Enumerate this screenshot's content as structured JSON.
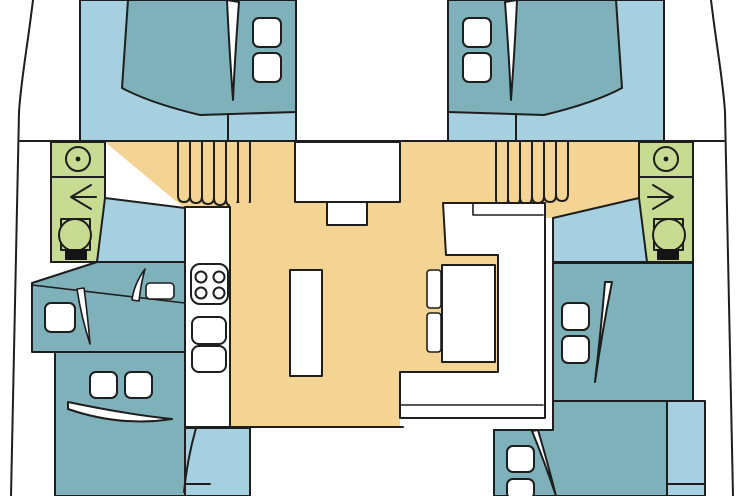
{
  "title": "Catamaran interior layout plan (top view)",
  "colors": {
    "background": "#FFFFFF",
    "floor": "#A6D0DF",
    "bed": "#7FB1BA",
    "salon": "#F3D494",
    "head": "#C7DB93",
    "white": "#FFFFFF",
    "outline": "#1E1E1E",
    "toilet_seat": "#141414"
  },
  "icons": [
    "shower-drain-icon",
    "arrow-left-icon",
    "arrow-right-icon",
    "toilet-icon",
    "stove-burners-icon",
    "sink-basin-icon",
    "door-swing-icon",
    "stairs-icon"
  ],
  "rooms": {
    "port_forward_cabin": "double berth cabin",
    "starboard_forward_cabin": "double berth cabin",
    "port_head": "bathroom with shower and toilet",
    "starboard_head": "bathroom with shower and toilet",
    "salon": "salon with galley, island and dinette",
    "galley": "counter with stove and two sinks",
    "dinette": "U-shaped settee with table and two cushions",
    "port_mid_cabin": "berth cabin",
    "port_aft_cabin": "double berth cabin",
    "starboard_mid_cabin": "double berth cabin",
    "starboard_aft_cabin": "double berth cabin",
    "stairs": "two companionway staircases"
  }
}
